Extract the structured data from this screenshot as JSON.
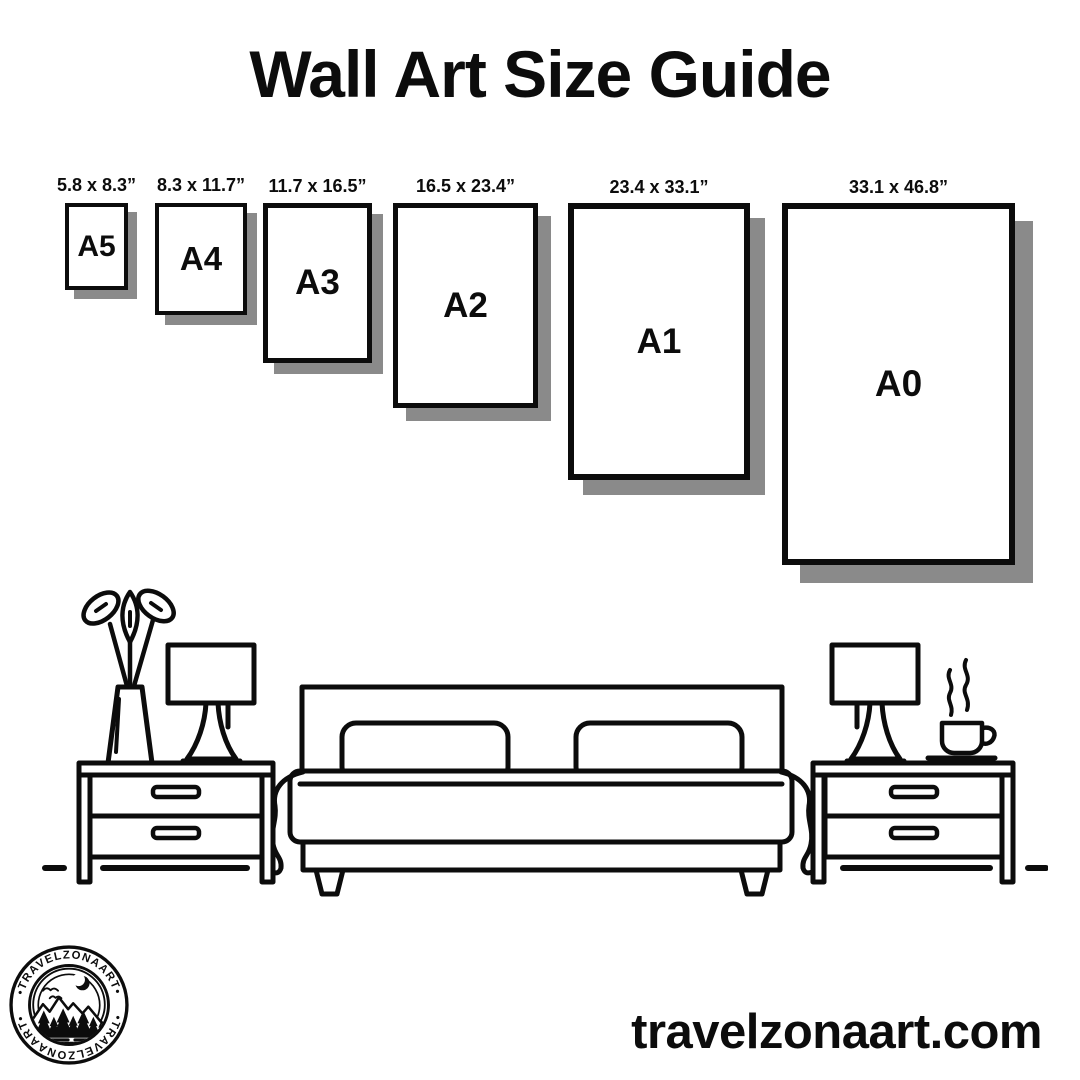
{
  "title": "Wall Art Size Guide",
  "papers": [
    {
      "name": "A5",
      "dims": "5.8 x 8.3”"
    },
    {
      "name": "A4",
      "dims": "8.3 x 11.7”"
    },
    {
      "name": "A3",
      "dims": "11.7 x 16.5”"
    },
    {
      "name": "A2",
      "dims": "16.5 x 23.4”"
    },
    {
      "name": "A1",
      "dims": "23.4 x 33.1”"
    },
    {
      "name": "A0",
      "dims": "33.1 x 46.8”"
    }
  ],
  "logo": {
    "arc_text_top": "•TRAVELZONAART•",
    "arc_text_bottom": "•TRAVELZONAART•"
  },
  "footer": {
    "website": "travelzonaart.com"
  },
  "scene_icons": [
    "flower-vase-icon",
    "table-lamp-icon",
    "nightstand-icon",
    "bed-icon",
    "coffee-cup-icon",
    "floor-line"
  ],
  "colors": {
    "ink": "#0c0c0c",
    "paper_shadow": "#8a8a8a",
    "background": "#ffffff"
  }
}
